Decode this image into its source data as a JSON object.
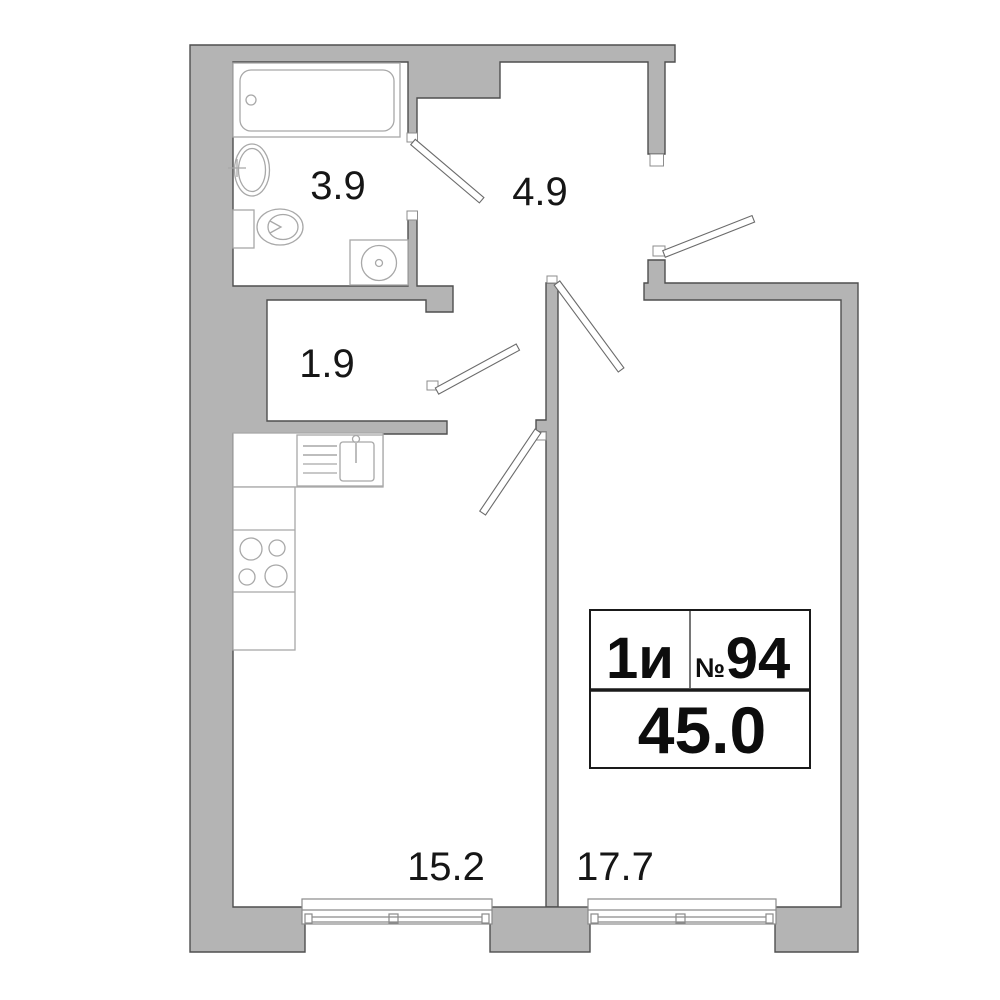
{
  "plan": {
    "title": "apartment-floor-plan",
    "rooms": [
      {
        "name": "bathroom",
        "area": "3.9"
      },
      {
        "name": "hallway",
        "area": "4.9"
      },
      {
        "name": "storage",
        "area": "1.9"
      },
      {
        "name": "kitchen-living-room",
        "area": "15.2"
      },
      {
        "name": "bedroom",
        "area": "17.7"
      }
    ],
    "info_card": {
      "apartment_type": "1и",
      "number_sign": "№",
      "apartment_number": "94",
      "total_area": "45.0"
    },
    "fixtures": [
      "bathtub",
      "washbasin",
      "toilet",
      "washing-machine",
      "kitchen-sink",
      "stove",
      "window"
    ],
    "colors": {
      "background": "#ffffff",
      "wall_fill": "#b4b4b4",
      "wall_stroke": "#4f4f4f",
      "fixture_stroke": "#a8a8a8",
      "door_stroke": "#6b6b6b",
      "label_text": "#161616"
    }
  }
}
